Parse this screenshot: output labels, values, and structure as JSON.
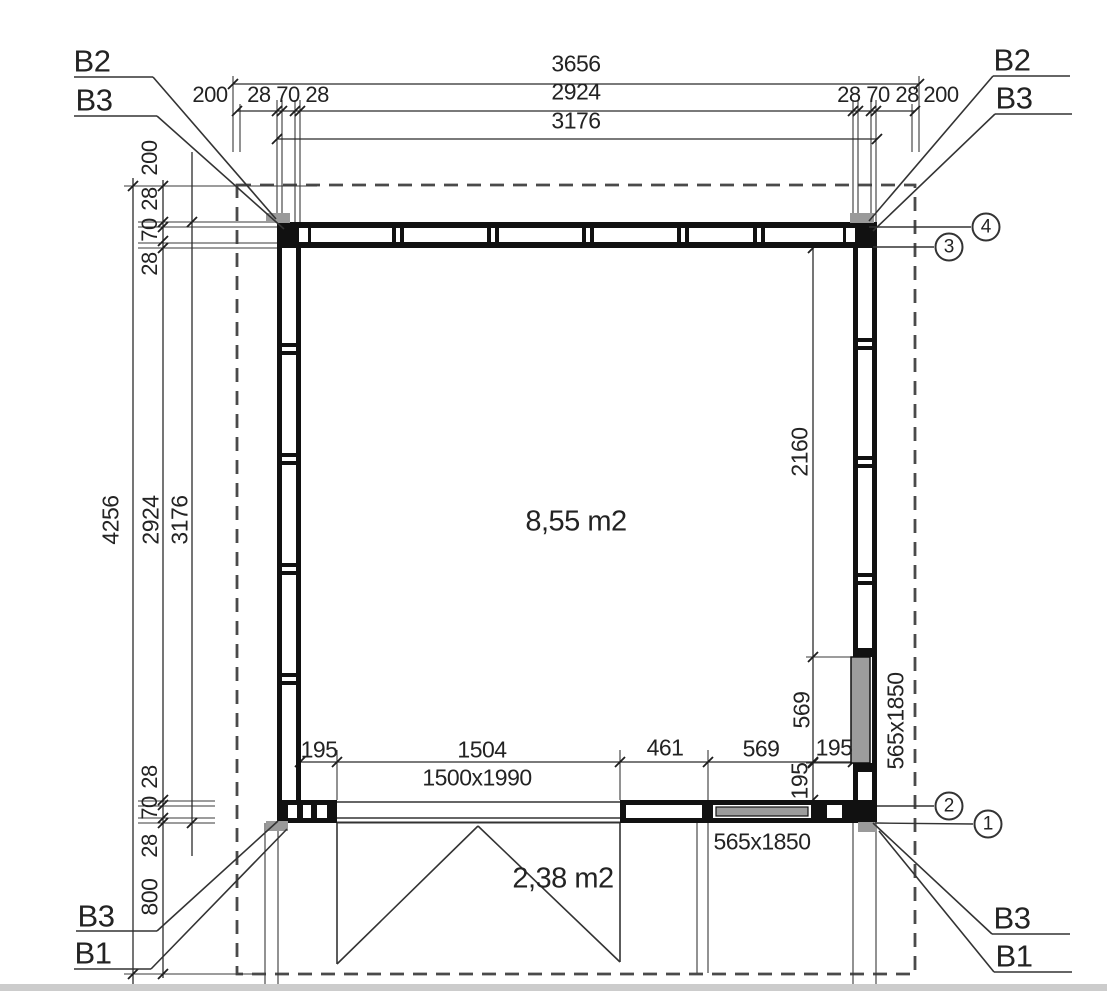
{
  "plan": {
    "section_markers": {
      "top_left": [
        "B2",
        "B3"
      ],
      "top_right": [
        "B2",
        "B3"
      ],
      "bottom_left": [
        "B3",
        "B1"
      ],
      "bottom_right": [
        "B3",
        "B1"
      ]
    },
    "grid_bubbles": [
      "4",
      "3",
      "2",
      "1"
    ],
    "dimensions": {
      "top": {
        "overall": "3656",
        "clear": "2924",
        "outer": "3176",
        "overhang_left": "200",
        "wall_left": "28 70 28",
        "wall_right": "28 70 28",
        "overhang_right": "200"
      },
      "left": {
        "overall": "4256",
        "clear": "2924",
        "outer": "3176",
        "overhang_top": "200",
        "wall_top": [
          "28",
          "70",
          "28"
        ],
        "wall_bottom": [
          "28",
          "70",
          "28"
        ],
        "porch_depth": "800"
      },
      "interior": {
        "right_wall_clear": "2160",
        "window_offset_v": "569",
        "window_jamb_v": "195",
        "door_offset": "195",
        "door_width": "1504",
        "pier": "461",
        "window_offset_h": "569",
        "window_jamb_h": "195"
      }
    },
    "openings": {
      "door": "1500x1990",
      "window_bottom": "565x1850",
      "window_right": "565x1850"
    },
    "areas": {
      "main": "8,55 m2",
      "porch": "2,38 m2"
    }
  }
}
